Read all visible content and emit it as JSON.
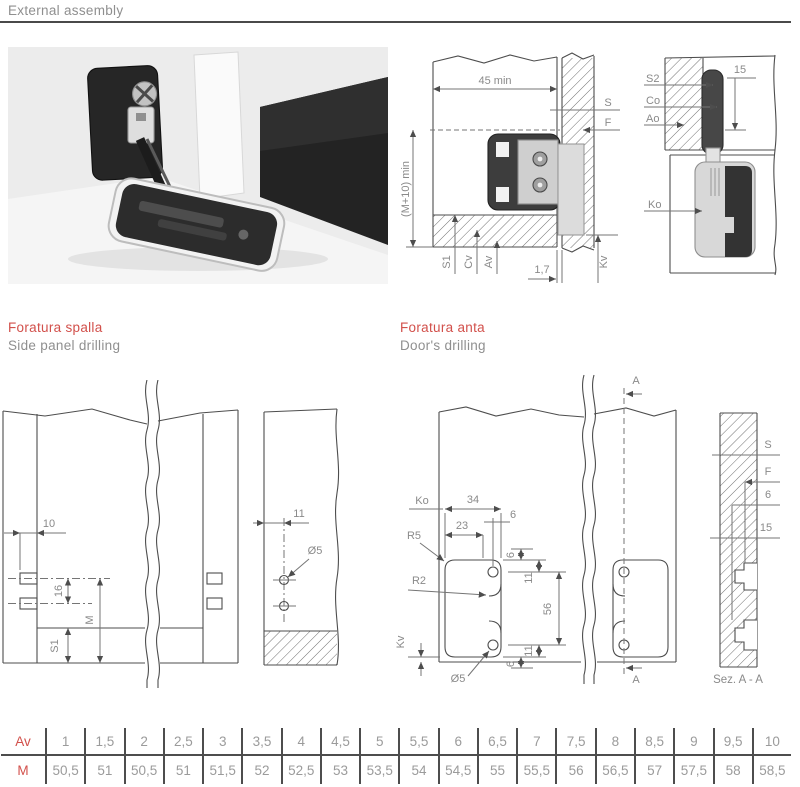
{
  "page": {
    "title": "External assembly"
  },
  "assembly_section": {
    "dim_depth": "45 min",
    "label_S": "S",
    "label_F": "F",
    "dim_height": "(M+10) min",
    "label_S1": "S1",
    "label_Cv": "Cv",
    "label_Av": "Av",
    "dim_gap": "1,7",
    "label_Kv": "Kv"
  },
  "assembly_detail": {
    "label_S2": "S2",
    "label_Co": "Co",
    "label_Ao": "Ao",
    "dim_15": "15",
    "label_Ko": "Ko"
  },
  "spalla": {
    "title": "Foratura spalla",
    "subtitle": "Side panel drilling",
    "dim_10": "10",
    "dim_16": "16",
    "label_M": "M",
    "label_S1": "S1",
    "dim_11": "11",
    "dim_hole": "Ø5"
  },
  "anta": {
    "title": "Foratura anta",
    "subtitle": "Door's drilling",
    "label_Ko": "Ko",
    "dim_34": "34",
    "dim_23": "23",
    "dim_6_top": "6",
    "label_R5": "R5",
    "label_R2": "R2",
    "dim_6_upper": "6",
    "dim_11_upper": "11",
    "dim_56": "56",
    "dim_11_lower": "11",
    "dim_6_lower": "6",
    "label_Kv": "Kv",
    "dim_hole": "Ø5",
    "section_A_top": "A",
    "section_A_bottom": "A"
  },
  "section_aa": {
    "label_S": "S",
    "label_F": "F",
    "dim_6": "6",
    "dim_15": "15",
    "caption": "Sez. A - A"
  },
  "table": {
    "row_av_label": "Av",
    "row_m_label": "M",
    "av": [
      "1",
      "1,5",
      "2",
      "2,5",
      "3",
      "3,5",
      "4",
      "4,5",
      "5",
      "5,5",
      "6",
      "6,5",
      "7",
      "7,5",
      "8",
      "8,5",
      "9",
      "9,5",
      "10"
    ],
    "m": [
      "50,5",
      "51",
      "50,5",
      "51",
      "51,5",
      "52",
      "52,5",
      "53",
      "53,5",
      "54",
      "54,5",
      "55",
      "55,5",
      "56",
      "56,5",
      "57",
      "57,5",
      "58",
      "58,5"
    ]
  },
  "colors": {
    "accent_red": "#d2504b",
    "text_gray": "#8f8f8f",
    "line_dark": "#4d4d4d"
  }
}
